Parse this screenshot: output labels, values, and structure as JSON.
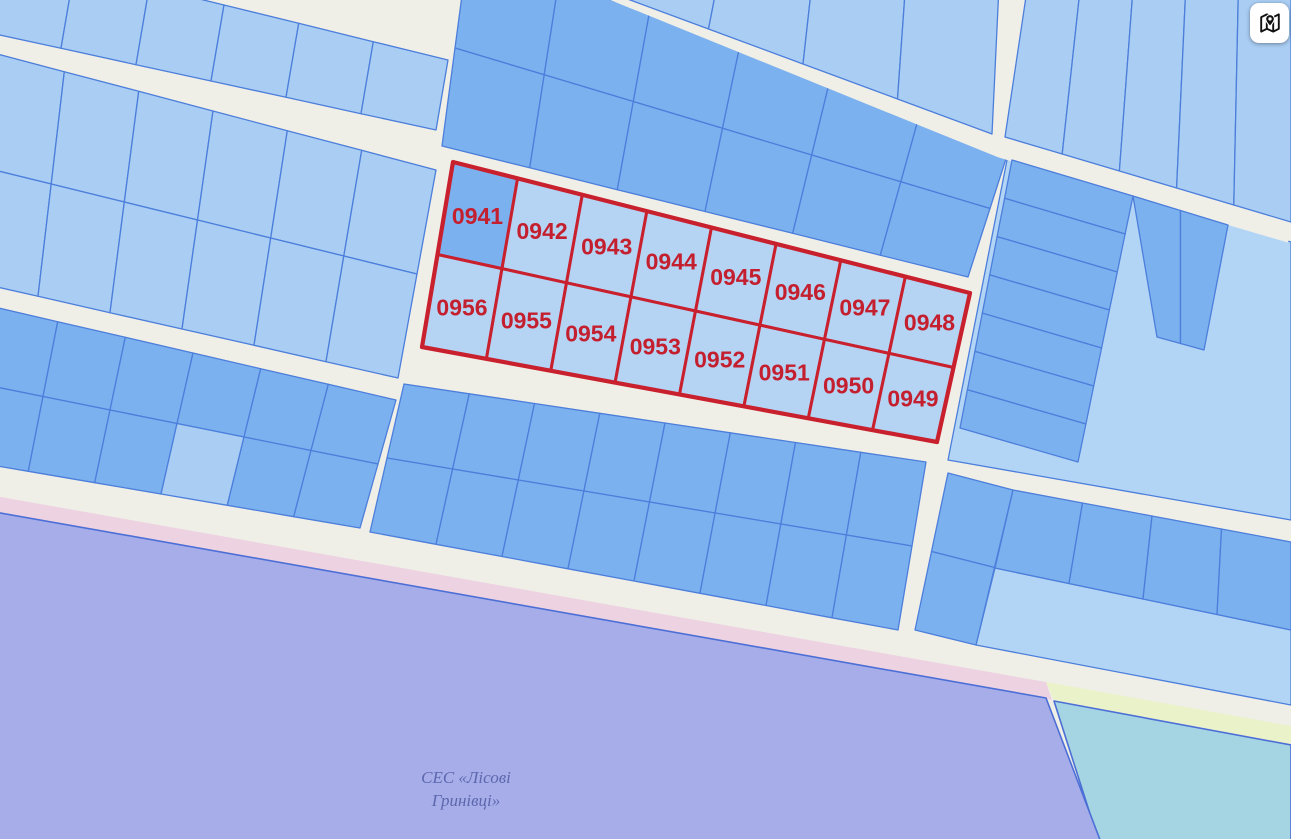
{
  "map": {
    "selected_parcels": [
      {
        "label": "0941"
      },
      {
        "label": "0942"
      },
      {
        "label": "0943"
      },
      {
        "label": "0944"
      },
      {
        "label": "0945"
      },
      {
        "label": "0946"
      },
      {
        "label": "0947"
      },
      {
        "label": "0948"
      },
      {
        "label": "0956"
      },
      {
        "label": "0955"
      },
      {
        "label": "0954"
      },
      {
        "label": "0953"
      },
      {
        "label": "0952"
      },
      {
        "label": "0951"
      },
      {
        "label": "0950"
      },
      {
        "label": "0949"
      }
    ],
    "zone_label": {
      "line1": "СЕС «Лісові",
      "line2": "Гринівці»"
    },
    "colors": {
      "road": "#f0efe7",
      "parcel_light": "#a9cdf3",
      "parcel_lighter": "#b3d5f5",
      "parcel_medium": "#7cb1ef",
      "parcel_border": "#4c7edb",
      "selection_red": "#c9202e",
      "selection_label_red": "#c41f2e",
      "selected_fill": "#b5d3f2",
      "zone_purple": "#a7ade9",
      "zone_purple_border": "#4c6fd6",
      "strip_pink": "#edd2e2",
      "strip_yellow": "#e9f2c8",
      "zone_teal": "#a5d5e2",
      "zone_label_text": "#5c67ad"
    }
  },
  "controls": {
    "map_button_icon": "map-pin-icon"
  }
}
